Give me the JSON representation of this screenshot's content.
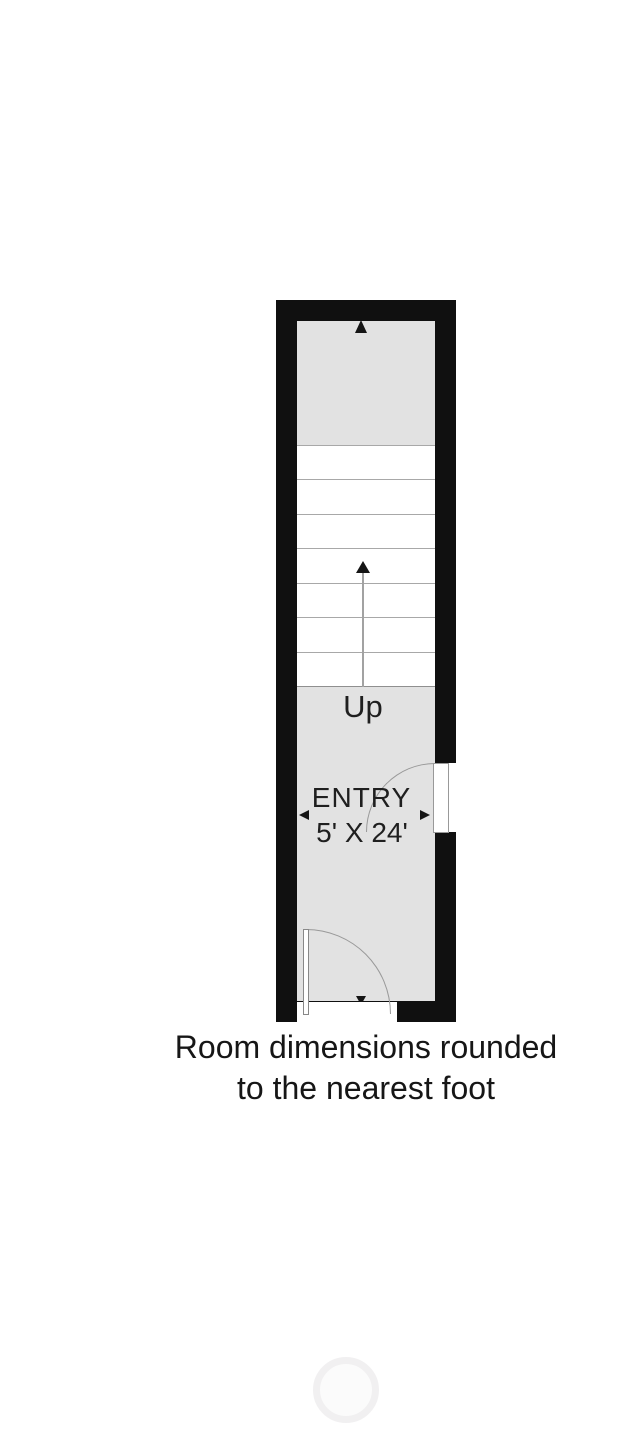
{
  "floor_plan": {
    "stairs": {
      "up_label": "Up",
      "tread_count": "7"
    },
    "room": {
      "name": "ENTRY",
      "size": "5' X 24'"
    },
    "colors": {
      "wall": "#101010",
      "floor": "#e2e2e2",
      "stair_tread": "#ffffff",
      "tread_line": "#a8a8a8",
      "door_line": "#999999",
      "arrow": "#151515"
    }
  },
  "caption": {
    "line1": "Room dimensions rounded",
    "line2": "to the nearest foot"
  },
  "watermark": {
    "shape": "faint-circle"
  }
}
